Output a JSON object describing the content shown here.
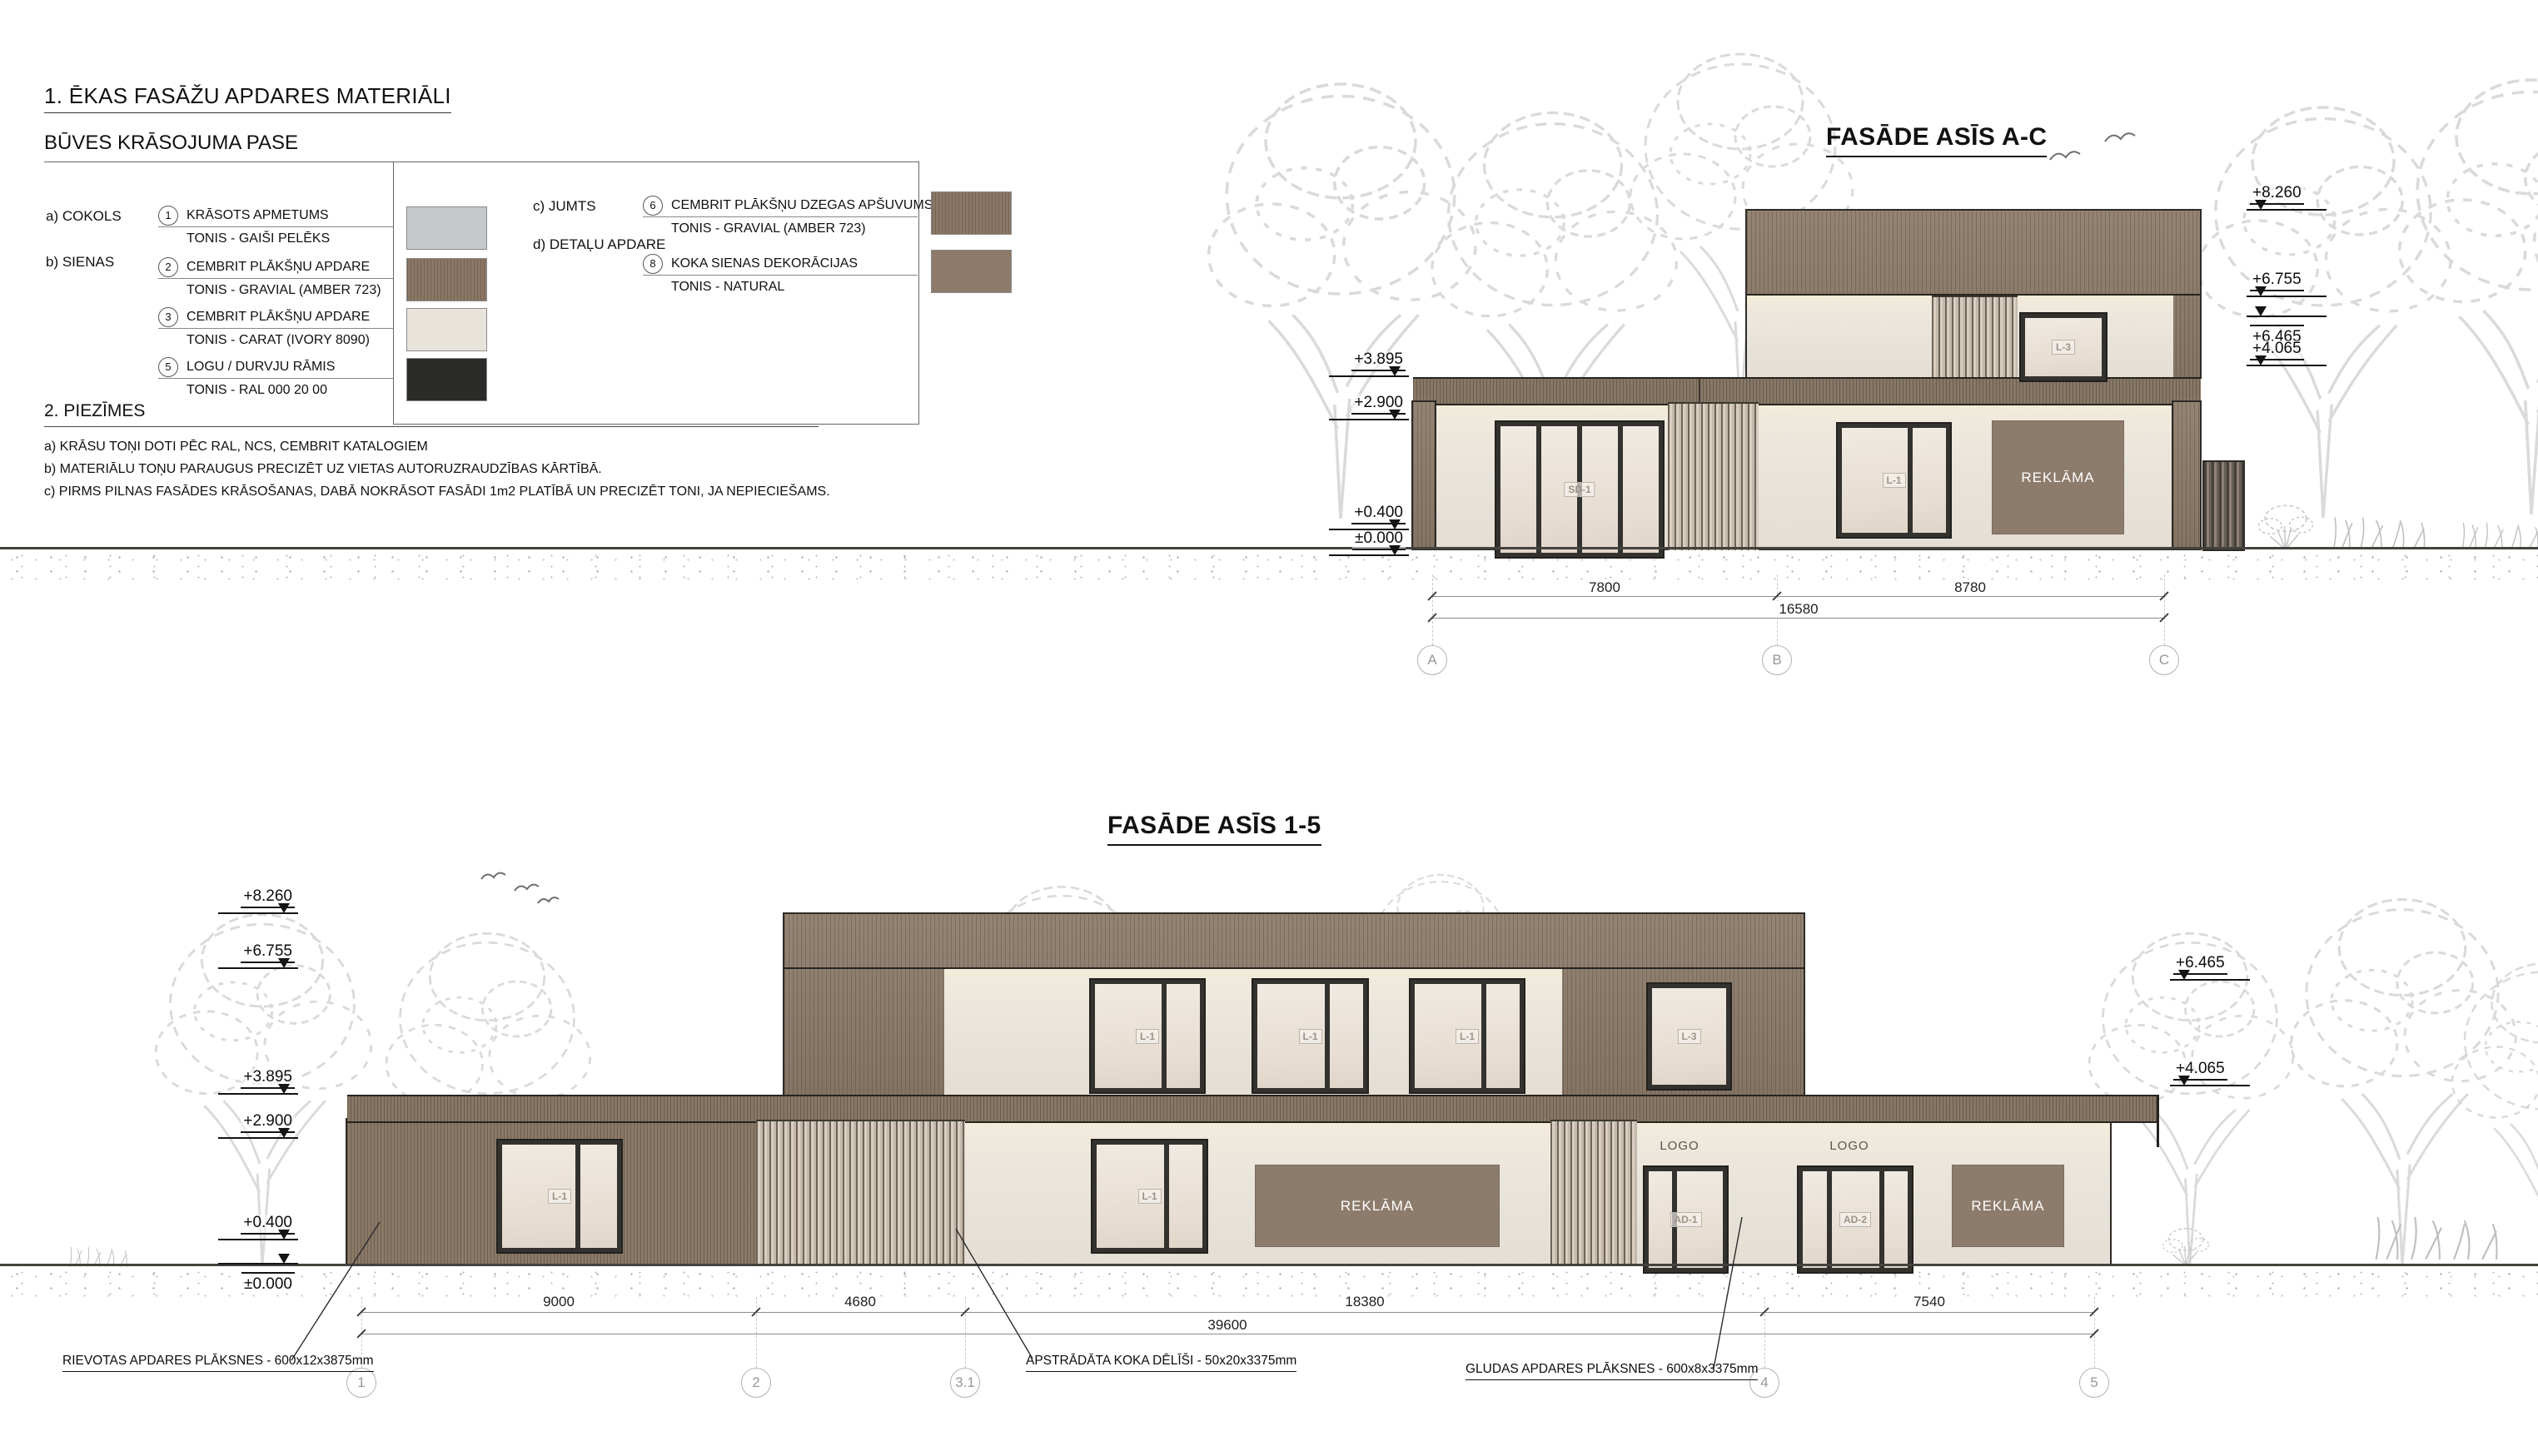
{
  "legend": {
    "title": "1. ĒKAS FASĀŽU APDARES MATERIĀLI",
    "subtitle": "BŪVES KRĀSOJUMA PASE",
    "cat_a": "a) COKOLS",
    "cat_b": "b) SIENAS",
    "cat_c": "c) JUMTS",
    "cat_d": "d) DETAĻU APDARE",
    "items": [
      {
        "num": "1",
        "name": "KRĀSOTS APMETUMS",
        "tone": "TONIS - GAIŠI PELĒKS",
        "color": "#c6c9cc"
      },
      {
        "num": "2",
        "name": "CEMBRIT PLĀKŠŅU APDARE",
        "tone": "TONIS -  GRAVIAL (AMBER 723)",
        "color": "#8b7765"
      },
      {
        "num": "3",
        "name": "CEMBRIT PLĀKŠŅU APDARE",
        "tone": "TONIS -  CARAT (IVORY 8090)",
        "color": "#e8e4db"
      },
      {
        "num": "5",
        "name": "LOGU / DURVJU RĀMIS",
        "tone": "TONIS - RAL 000 20 00",
        "color": "#2b2b29"
      },
      {
        "num": "6",
        "name": "CEMBRIT PLĀKŠŅU DZEGAS APŠUVUMS",
        "tone": "TONIS -  GRAVIAL (AMBER 723)",
        "color": "#8b7765"
      },
      {
        "num": "8",
        "name": "KOKA SIENAS DEKORĀCIJAS",
        "tone": "TONIS - NATURAL",
        "color": "#8d7a68"
      }
    ]
  },
  "notes": {
    "title": "2. PIEZĪMES",
    "a": "a) KRĀSU TOŅI DOTI PĒC RAL, NCS, CEMBRIT KATALOGIEM",
    "b": "b) MATERIĀLU TOŅU PARAUGUS PRECIZĒT UZ VIETAS AUTORUZRAUDZĪBAS KĀRTĪBĀ.",
    "c": "c) PIRMS PILNAS FASĀDES KRĀSOŠANAS, DABĀ NOKRĀSOT FASĀDI 1m2 PLATĪBĀ UN PRECIZĒT TONI, JA NEPIECIEŠAMS."
  },
  "facade_ac": {
    "title": "FASĀDE ASĪS A-C",
    "marks_right": [
      "+8.260",
      "+6.755",
      "+6.465",
      "+4.065"
    ],
    "marks_left": [
      "+3.895",
      "+2.900",
      "+0.400",
      "±0.000"
    ],
    "dims": [
      "7800",
      "8780"
    ],
    "dim_total": "16580",
    "grids": [
      "A",
      "B",
      "C"
    ],
    "door_label": "SD-1",
    "window_label": "L-1",
    "upper_window_label": "L-3",
    "sign": "REKLĀMA"
  },
  "facade_15": {
    "title": "FASĀDE ASĪS 1-5",
    "marks_left": [
      "+8.260",
      "+6.755",
      "+3.895",
      "+2.900",
      "+0.400",
      "±0.000"
    ],
    "marks_right": [
      "+6.465",
      "+4.065"
    ],
    "dims": [
      "9000",
      "4680",
      "18380",
      "7540"
    ],
    "dim_total": "39600",
    "grids": [
      "1",
      "2",
      "3.1",
      "4",
      "5"
    ],
    "upper_windows": [
      "L-1",
      "L-1",
      "L-1",
      "L-3"
    ],
    "ground_windows": [
      "L-1",
      "L-1"
    ],
    "doors": [
      "AD-1",
      "AD-2"
    ],
    "logo": "LOGO",
    "sign": "REKLĀMA",
    "callouts": [
      "RIEVOTAS APDARES PLĀKSNES - 600x12x3875mm",
      "APSTRĀDĀTA KOKA DĒLĪŠI - 50x20x3375mm",
      "GLUDAS APDARES PLĀKSNES - 600x8x3375mm"
    ]
  },
  "colors": {
    "facade_brown": "#8e7d6c",
    "facade_ivory": "#e9e4db",
    "plaster_grey": "#c6c9cc",
    "frame_dark": "#2b2b29",
    "sign_brown": "#8d7c6c"
  }
}
